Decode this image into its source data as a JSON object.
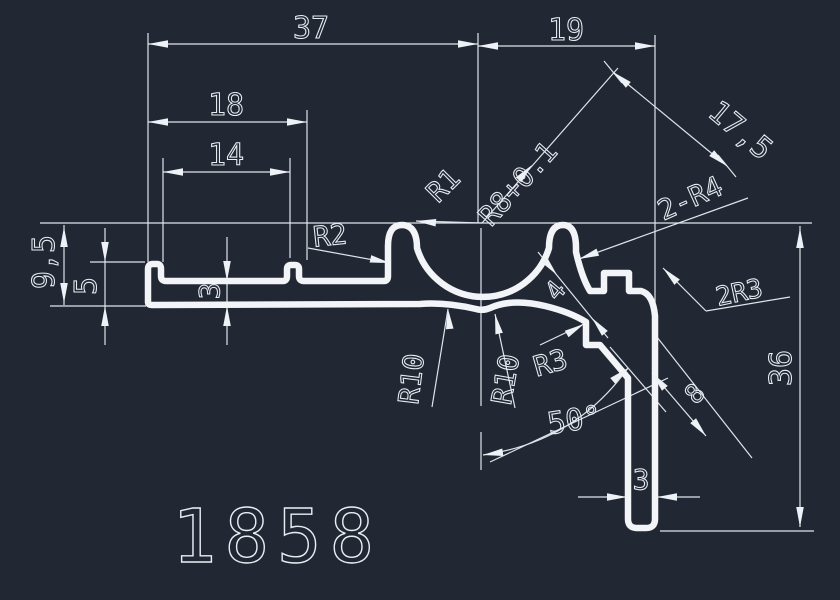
{
  "drawing": {
    "part_number": "1858",
    "background_color": "#212733",
    "line_color": "#e9edf3",
    "dims": {
      "overall_width": "37",
      "right_offset": "19",
      "slot_width": "18",
      "slot_inner_width": "14",
      "left_height": "9,5",
      "lip_height": "5",
      "left_wall": "3",
      "diagonal_length": "17,5",
      "arm_thickness": "4",
      "latch_length": "8",
      "angle": "50°",
      "leg_thickness": "3",
      "overall_height": "36"
    },
    "radii": {
      "r2": "R2",
      "r1": "R1",
      "r8_tol": "R8+0.1",
      "r10_left": "R10",
      "r10_right": "R10",
      "r3": "R3",
      "double_r4": "2-R4",
      "double_r3": "2R3"
    }
  }
}
